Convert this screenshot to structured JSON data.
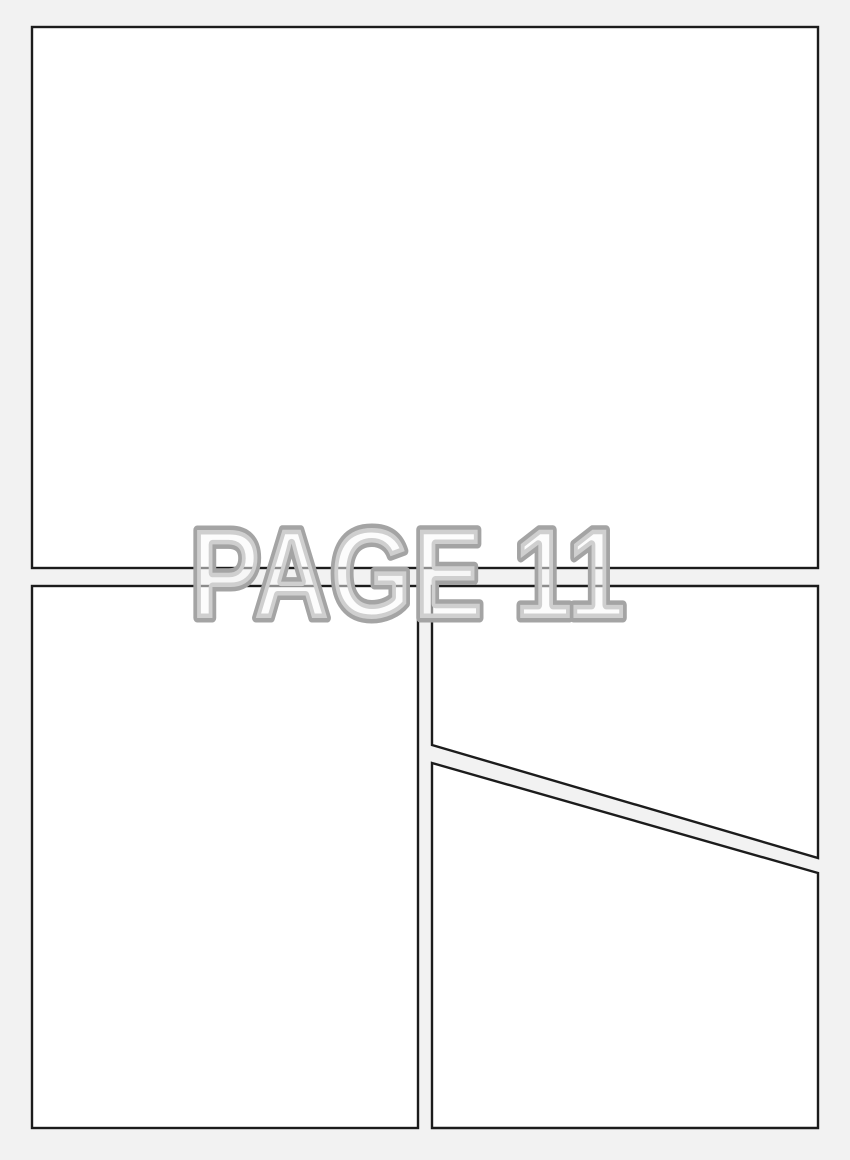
{
  "page": {
    "label": "PAGE 11",
    "page_number": 11,
    "panel_count": 4,
    "colors": {
      "background": "#f2f2f2",
      "panel_fill": "#ffffff",
      "panel_border": "#1c1c1c",
      "label_fill": "#fafafa",
      "label_outline": "#a4a4a4"
    }
  }
}
